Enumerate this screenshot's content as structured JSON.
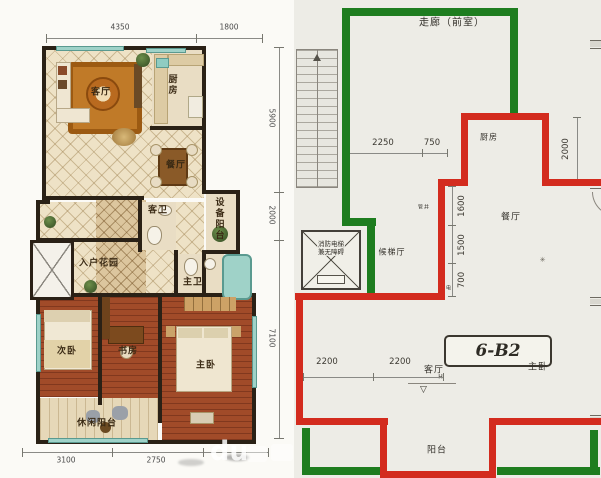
{
  "image_type": "floor-plan comparison (rendered plan vs technical drawing with marker overlays)",
  "left_plan": {
    "style": "color rendered apartment plan",
    "room_labels": [
      {
        "text": "客厅",
        "x": 101,
        "y": 91,
        "vertical": false
      },
      {
        "text": "厨房",
        "x": 172,
        "y": 85,
        "vertical": true
      },
      {
        "text": "餐厅",
        "x": 176,
        "y": 164,
        "vertical": false
      },
      {
        "text": "客卫",
        "x": 158,
        "y": 209,
        "vertical": false
      },
      {
        "text": "设备阳台",
        "x": 219,
        "y": 219,
        "vertical": true
      },
      {
        "text": "入户花园",
        "x": 99,
        "y": 262,
        "vertical": false
      },
      {
        "text": "主卫",
        "x": 193,
        "y": 281,
        "vertical": false
      },
      {
        "text": "次卧",
        "x": 67,
        "y": 350,
        "vertical": false
      },
      {
        "text": "书房",
        "x": 128,
        "y": 350,
        "vertical": false
      },
      {
        "text": "主卧",
        "x": 206,
        "y": 364,
        "vertical": false
      },
      {
        "text": "休闲阳台",
        "x": 97,
        "y": 422,
        "vertical": false
      }
    ],
    "dims_top": [
      {
        "text": "4350",
        "cx": 120
      },
      {
        "text": "1800",
        "cx": 229
      }
    ],
    "dims_right": [
      {
        "text": "5900",
        "cy": 118
      },
      {
        "text": "2000",
        "cy": 215
      },
      {
        "text": "7100",
        "cy": 338
      }
    ],
    "dims_bottom": [
      {
        "text": "3100",
        "cx": 66
      },
      {
        "text": "2750",
        "cx": 156
      }
    ],
    "watermark": "du"
  },
  "right_plan": {
    "style": "black-line architectural drawing with green and red marker outlines",
    "unit_label": "6-B2",
    "elevator_label": {
      "line1": "消防电梯",
      "line2": "兼无障碍"
    },
    "room_labels": [
      {
        "text": "走廊（前室）",
        "x": 452,
        "y": 21,
        "size": 10
      },
      {
        "text": "厨房",
        "x": 489,
        "y": 137,
        "size": 8
      },
      {
        "text": "餐厅",
        "x": 511,
        "y": 216,
        "size": 9
      },
      {
        "text": "候梯厅",
        "x": 392,
        "y": 252,
        "size": 8
      },
      {
        "text": "客厅",
        "x": 434,
        "y": 369,
        "size": 9
      },
      {
        "text": "主卧",
        "x": 538,
        "y": 366,
        "size": 9
      },
      {
        "text": "阳台",
        "x": 437,
        "y": 449,
        "size": 9
      },
      {
        "text": "强电",
        "x": 446,
        "y": 288,
        "size": 5
      },
      {
        "text": "管井",
        "x": 424,
        "y": 207,
        "size": 5
      }
    ],
    "dims": [
      {
        "text": "2250",
        "x": 383,
        "y": 143,
        "vertical": false
      },
      {
        "text": "750",
        "x": 432,
        "y": 143,
        "vertical": false
      },
      {
        "text": "2000",
        "x": 566,
        "y": 149,
        "vertical": true
      },
      {
        "text": "1600",
        "x": 462,
        "y": 206,
        "vertical": true
      },
      {
        "text": "1500",
        "x": 462,
        "y": 245,
        "vertical": true
      },
      {
        "text": "700",
        "x": 462,
        "y": 280,
        "vertical": true
      },
      {
        "text": "2200",
        "x": 327,
        "y": 362,
        "vertical": false
      },
      {
        "text": "2200",
        "x": 400,
        "y": 362,
        "vertical": false
      }
    ],
    "overlay_colors": {
      "green": "#1e7d1f",
      "red": "#d32b1e"
    },
    "misc_marks": {
      "level_mark": "▽",
      "level_letter": "H",
      "sparkle": "✳"
    }
  }
}
